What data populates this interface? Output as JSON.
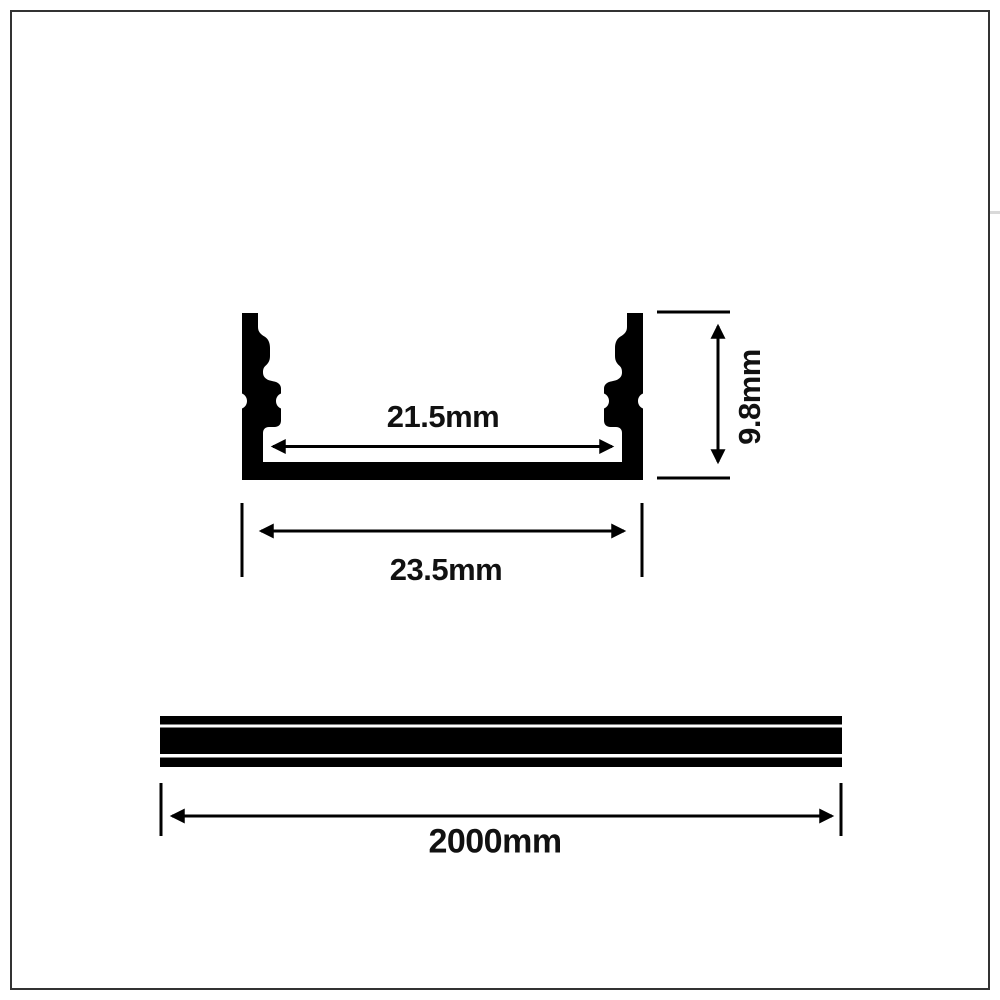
{
  "colors": {
    "background": "#ffffff",
    "ink": "#000000",
    "frame_border": "#333333",
    "text": "#111111"
  },
  "cross_section": {
    "inner_width": "21.5mm",
    "outer_width": "23.5mm",
    "height": "9.8mm"
  },
  "side_view": {
    "length": "2000mm"
  }
}
